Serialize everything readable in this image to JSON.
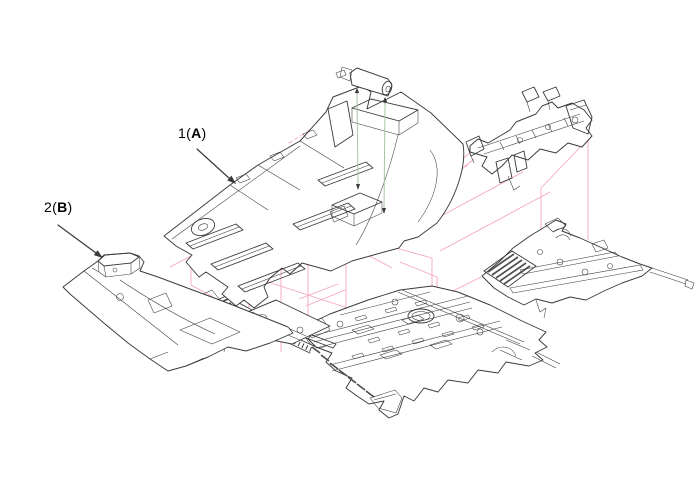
{
  "figure": {
    "type": "exploded-parts-diagram",
    "callouts": [
      {
        "prefix": "1(",
        "letter": "A",
        "suffix": ")"
      },
      {
        "prefix": "2(",
        "letter": "B",
        "suffix": ")"
      }
    ],
    "colors": {
      "background": "#ffffff",
      "line": "#3a3a3a",
      "projection": "#f5a3c6",
      "leader": "#a7c4a4",
      "label_text": "#000000",
      "hatch_fill": "#4f4f4f"
    }
  }
}
